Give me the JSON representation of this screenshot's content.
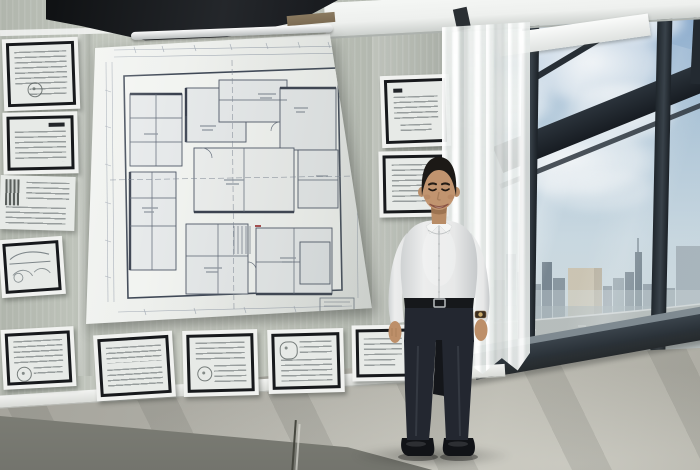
{
  "scene": {
    "description": "Smiling man in a white dress shirt standing in a bright high-rise office beside a wall covered with a large architectural floor plan and framed documents; floor-to-ceiling windows reveal a cloudy sky and a city skyline with a highway",
    "wall_display": {
      "blueprint_label": "large architectural floor-plan sheet",
      "left_column_frames": 4,
      "left_column_unframed_sheets": 1,
      "bottom_row_frames": 4,
      "right_column_frames": 2
    },
    "subject": {
      "label": "smiling man",
      "hair": "short black hair",
      "top": "white long-sleeve button-up shirt",
      "bottom": "dark navy trousers",
      "shoes": "black dress shoes",
      "accessories": [
        "black belt with silver buckle",
        "wristwatch"
      ]
    },
    "window": {
      "label": "floor-to-ceiling window wall",
      "view": [
        "blue sky with cumulus clouds",
        "city skyline",
        "elevated highway"
      ],
      "elements": [
        "dark mullions",
        "diagonal structural beam",
        "sheer white curtain"
      ]
    },
    "room": {
      "floor": "polished grey concrete floor",
      "ceiling": "dark exposed ceiling structure"
    }
  },
  "palette": {
    "wall": "#b9beb5",
    "ceiling_dark": "#17191d",
    "wood_trim": "#7b6a52",
    "soffit": "#eef0ee",
    "column": "#e6e9e6",
    "paper": "#edefec",
    "plan_line": "#4d5665",
    "plan_faint": "#9aa2ae",
    "rail": "#b9bdbd",
    "frame_black": "#17191c",
    "mat": "#f1f2f0",
    "doc_paper": "#e7eae7",
    "sky_top": "#7fa3cc",
    "sky_low": "#ccdbe3",
    "mullion": "#272e35",
    "sill": "#1d2329",
    "building_gray": "#7e8b95",
    "building_tan": "#cfc3ab",
    "road": "#b6bab6",
    "floor": "#b0afa7",
    "base_band": "#73746d",
    "skin": "#c1946f",
    "hair": "#1c1916",
    "shirt": "#eceded",
    "belt": "#16181b",
    "pants": "#232730",
    "shoe": "#111317",
    "watch_face": "#c9a96a"
  }
}
